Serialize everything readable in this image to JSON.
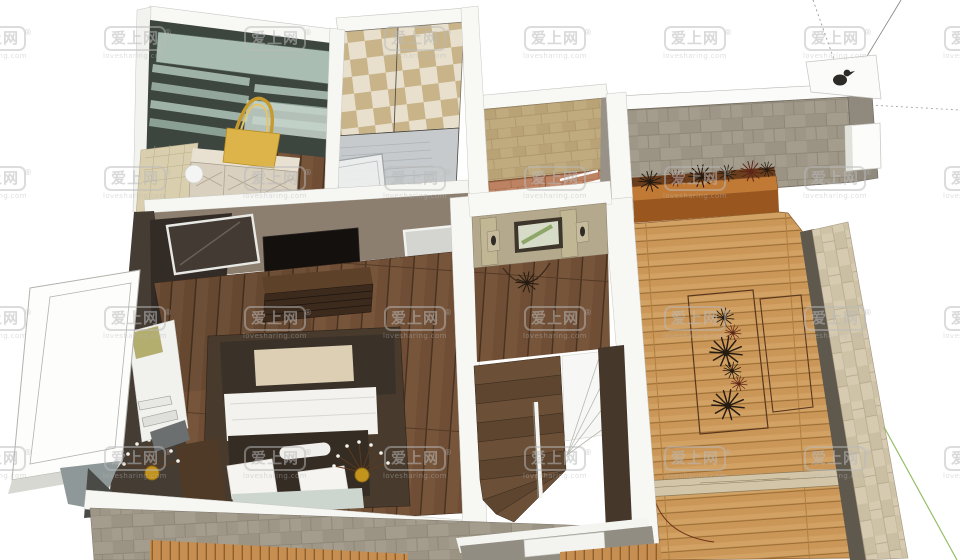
{
  "view": {
    "background_color": "#ffffff"
  },
  "watermark": {
    "text": "爱上网",
    "registered_mark": "®",
    "subtext": "lovesharing.com",
    "grid": {
      "cols": [
        -40,
        100,
        240,
        380,
        520,
        660,
        800,
        940
      ],
      "rows": [
        26,
        166,
        306,
        446
      ]
    }
  },
  "palette": {
    "background": "#ffffff",
    "deck_wood": "#d2a264",
    "bedroom_wood": "#6f4e35",
    "stone_wall": "#a49c8d",
    "parapet_stone": "#d6cab0",
    "checker_tan": "#c8b488",
    "checker_cream": "#e8e0cd",
    "tan_tile": "#c0ab7e",
    "terracotta_tile": "#bd8262",
    "closet_teal": "#aabdb2",
    "hall_wall": "#b4a98c",
    "planter_wood": "#c07a36",
    "bed_duvet": "#3a3129",
    "bed_linen": "#f3f2ee",
    "bed_runner": "#dccfb4",
    "plant_dark": "#251b11",
    "plant_red": "#5c2517",
    "accent_gold": "#ddb44a",
    "wall_white": "#f7f7f4",
    "axis_green": "#86b14e"
  }
}
